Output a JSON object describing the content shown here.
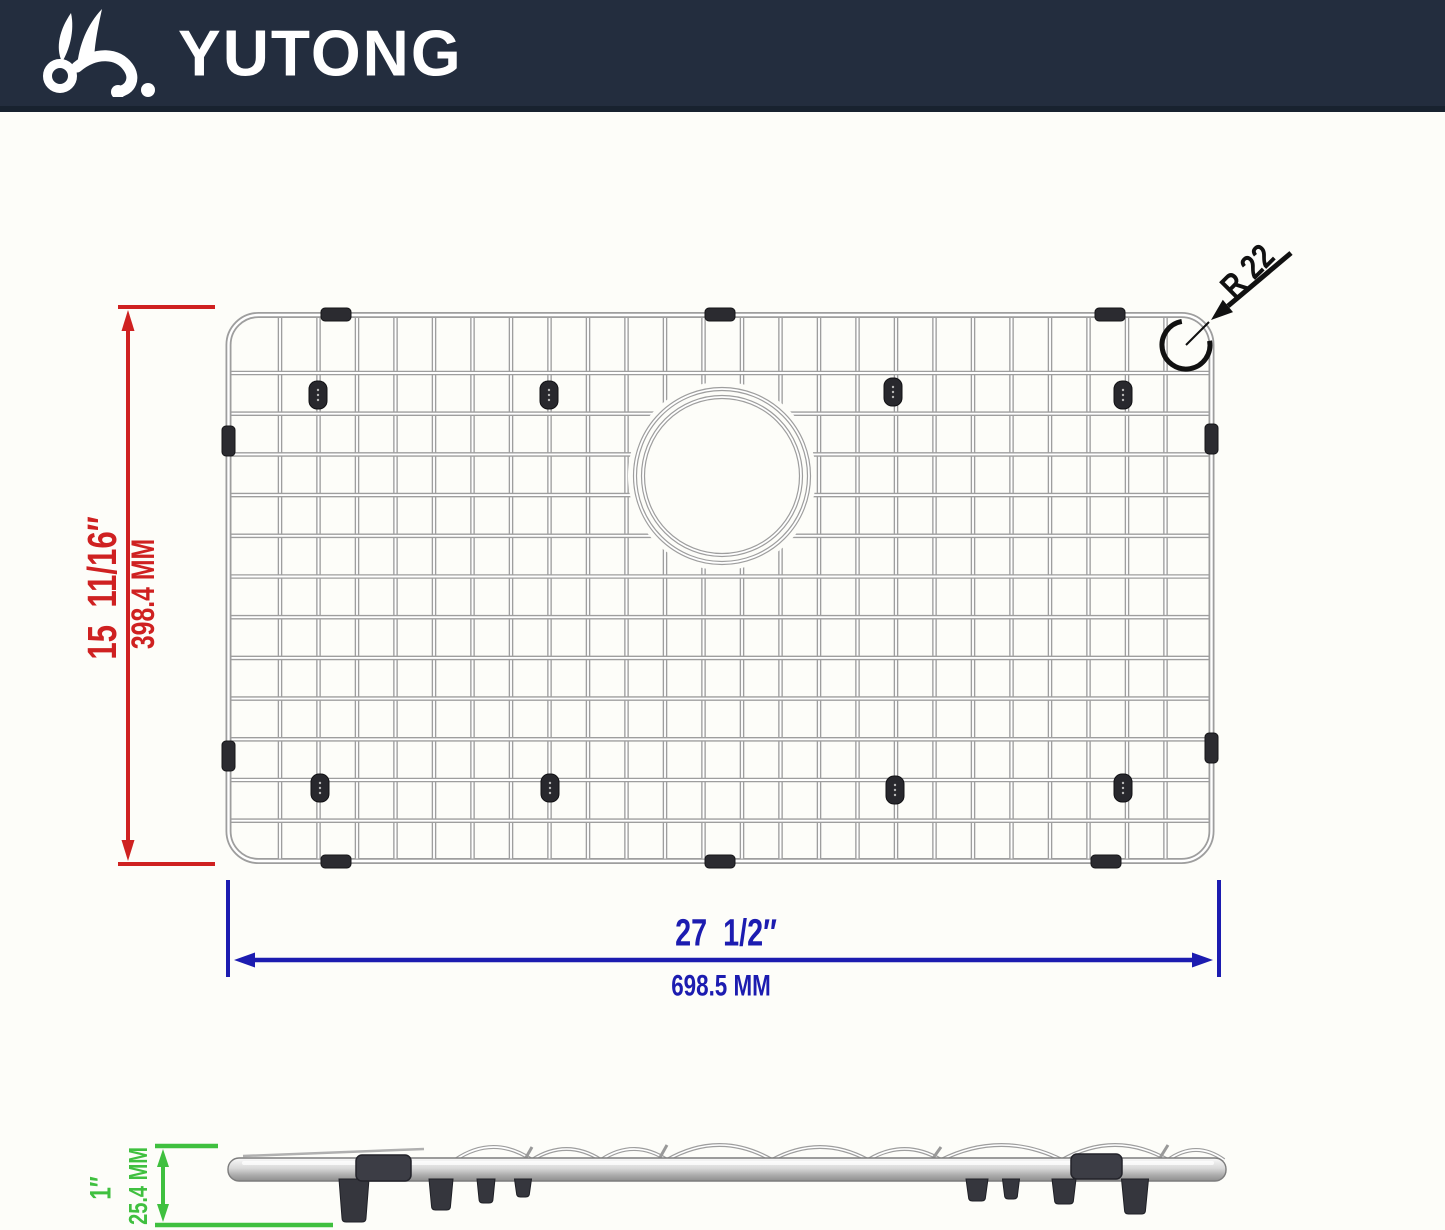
{
  "brand": {
    "name": "YUTONG",
    "logo_icon": "rabbit-icon",
    "header_bg_color": "#232d3e",
    "text_color": "#ffffff"
  },
  "diagram": {
    "subject": "stainless steel sink bottom grid with center drain hole",
    "views": [
      "top-view",
      "side-profile-view"
    ],
    "wire_color": "#9e9e9e",
    "bumper_color": "#2b2b30",
    "dimensions": {
      "width": {
        "inches": "27  1/2″",
        "mm": "698.5 MM",
        "color": "#1c1cb0",
        "orientation": "horizontal-bottom"
      },
      "height": {
        "inches": "15  11/16″",
        "mm": "398.4 MM",
        "color": "#cf2121",
        "orientation": "vertical-left"
      },
      "thickness": {
        "inches": "1″",
        "mm": "25.4 MM",
        "color": "#3fc03f",
        "orientation": "vertical-side-view"
      },
      "corner_radius": {
        "label": "R 22",
        "color": "#111111"
      }
    }
  }
}
